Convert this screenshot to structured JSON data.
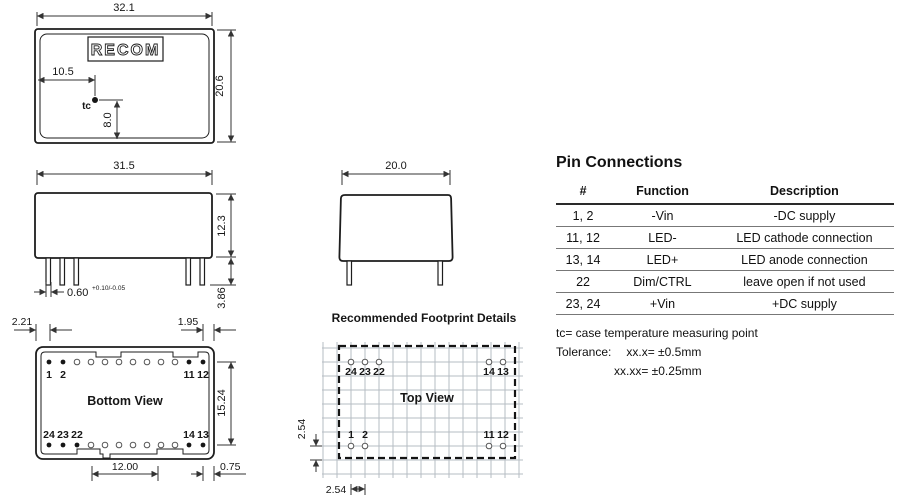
{
  "drawings": {
    "top_view": {
      "logo": "RECOM",
      "dim_width": "32.1",
      "dim_height": "20.6",
      "dim_tc_x": "10.5",
      "dim_tc_y": "8.0",
      "tc_label": "tc"
    },
    "side_view": {
      "dim_width": "31.5",
      "dim_height": "12.3",
      "dim_pin_width": "0.60",
      "dim_pin_width_tol": "+0.10/-0.05",
      "dim_pin_length": "3.86"
    },
    "front_view": {
      "dim_width": "20.0"
    },
    "bottom_view": {
      "title": "Bottom View",
      "dim_left_offset": "2.21",
      "dim_right_offset": "1.95",
      "dim_row_pitch": "15.24",
      "dim_span": "12.00",
      "dim_edge": "0.75",
      "pin_labels_top": [
        "1",
        "2",
        "11",
        "12"
      ],
      "pin_labels_bottom": [
        "24",
        "23",
        "22",
        "14",
        "13"
      ]
    },
    "footprint": {
      "heading": "Recommended Footprint Details",
      "title": "Top View",
      "dim_pitch_v": "2.54",
      "dim_pitch_h": "2.54",
      "pin_labels_top": [
        "24",
        "23",
        "22",
        "14",
        "13"
      ],
      "pin_labels_bottom": [
        "1",
        "2",
        "11",
        "12"
      ]
    }
  },
  "pin_connections": {
    "title": "Pin Connections",
    "headers": [
      "#",
      "Function",
      "Description"
    ],
    "rows": [
      [
        "1, 2",
        "-Vin",
        "-DC supply"
      ],
      [
        "11, 12",
        "LED-",
        "LED cathode connection"
      ],
      [
        "13, 14",
        "LED+",
        "LED anode connection"
      ],
      [
        "22",
        "Dim/CTRL",
        "leave open if not used"
      ],
      [
        "23, 24",
        "+Vin",
        "+DC supply"
      ]
    ],
    "notes": {
      "tc": "tc= case temperature measuring point",
      "tolerance_label": "Tolerance:",
      "tolerance_1": "xx.x= ±0.5mm",
      "tolerance_2": "xx.xx= ±0.25mm"
    }
  },
  "colors": {
    "line": "#1d1d1d",
    "grid": "#b6bcc3"
  }
}
